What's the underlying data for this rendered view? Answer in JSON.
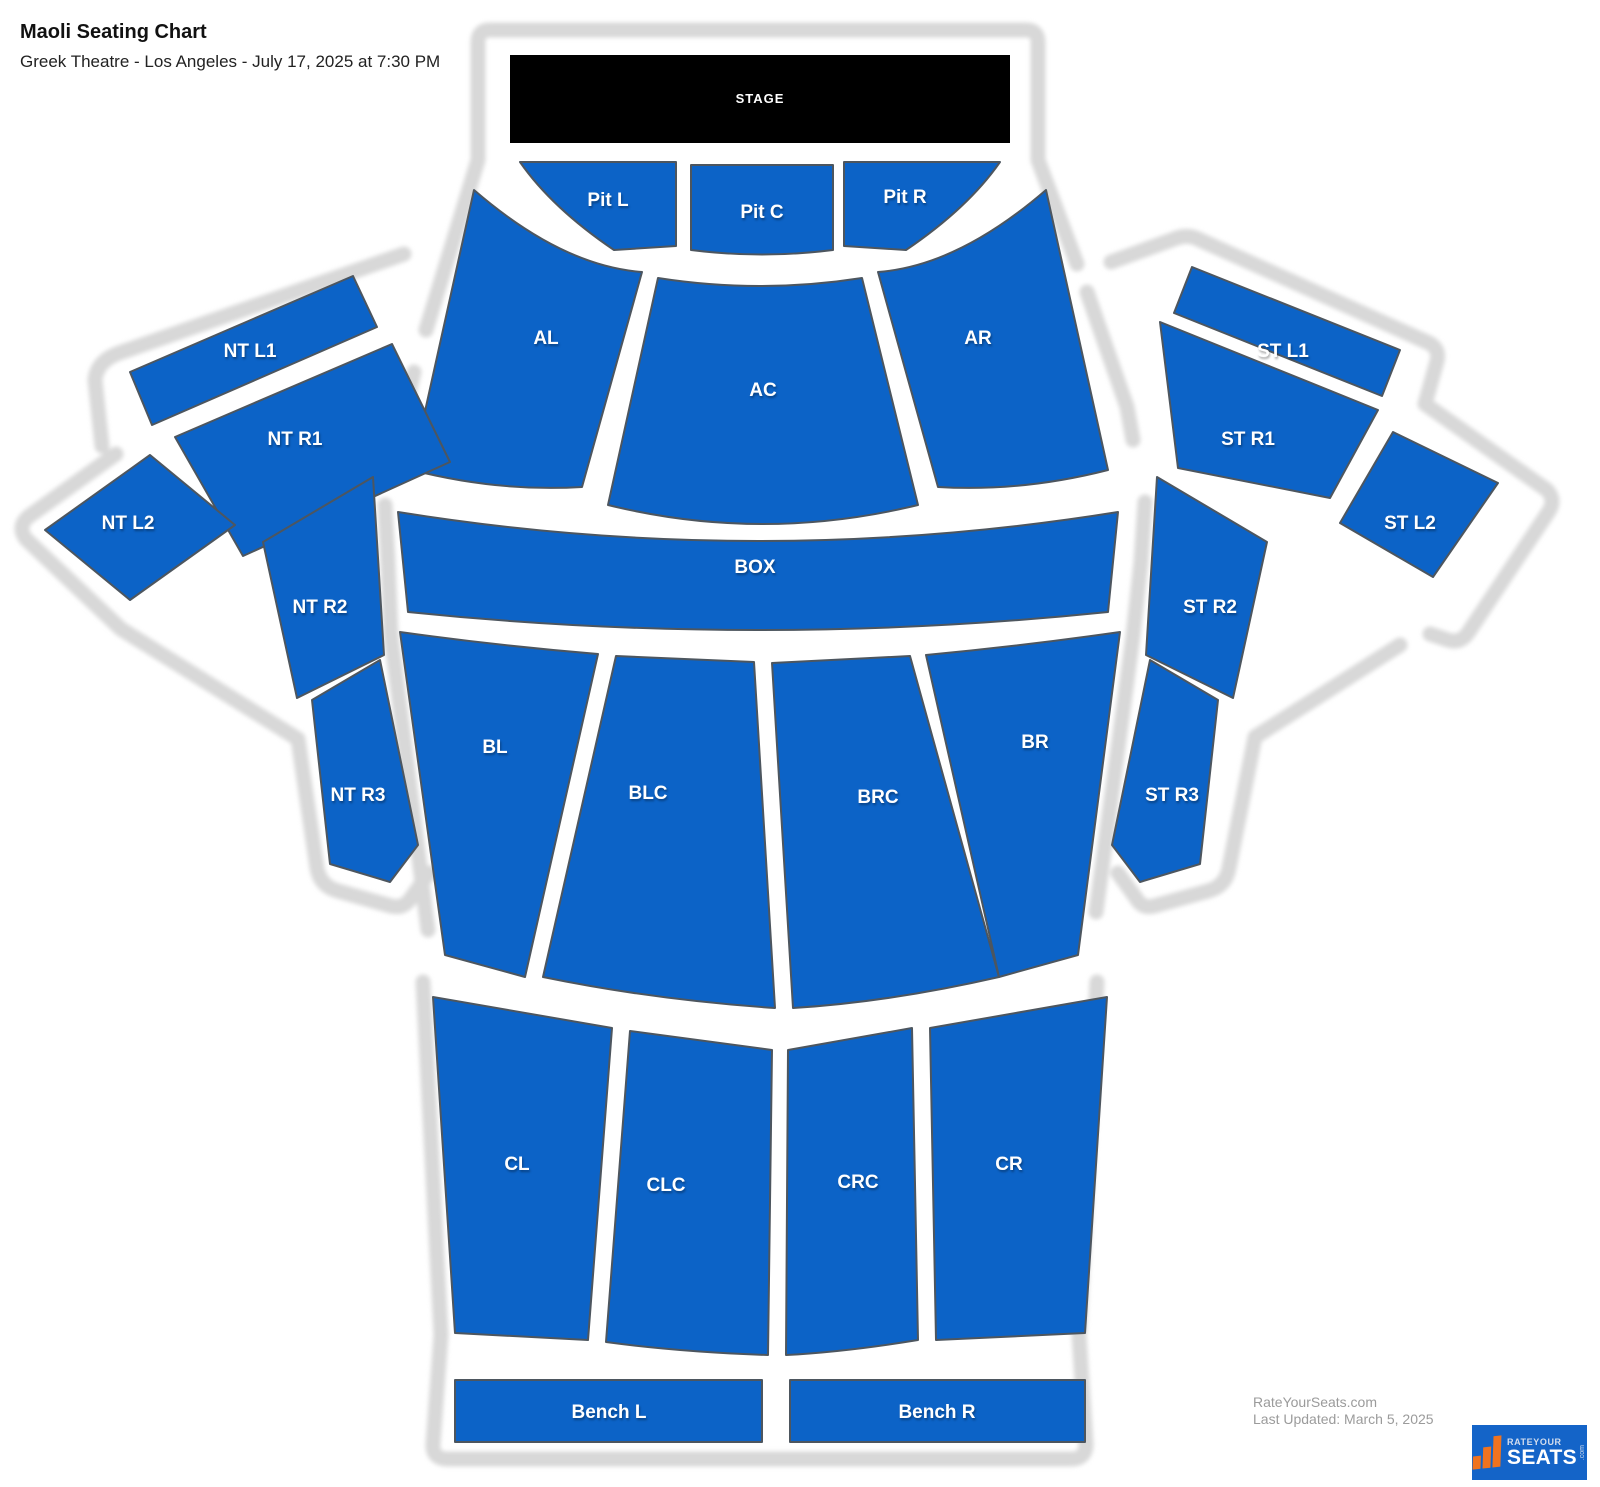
{
  "header": {
    "title": "Maoli Seating Chart",
    "subtitle": "Greek Theatre - Los Angeles - July 17, 2025 at 7:30 PM"
  },
  "stage": {
    "label": "STAGE"
  },
  "sections": {
    "pit_l": {
      "label": "Pit L"
    },
    "pit_c": {
      "label": "Pit C"
    },
    "pit_r": {
      "label": "Pit R"
    },
    "al": {
      "label": "AL"
    },
    "ac": {
      "label": "AC"
    },
    "ar": {
      "label": "AR"
    },
    "box": {
      "label": "BOX"
    },
    "nt_l1": {
      "label": "NT L1"
    },
    "nt_r1": {
      "label": "NT R1"
    },
    "nt_l2": {
      "label": "NT L2"
    },
    "nt_r2": {
      "label": "NT R2"
    },
    "nt_r3": {
      "label": "NT R3"
    },
    "st_l1": {
      "label": "ST L1"
    },
    "st_r1": {
      "label": "ST R1"
    },
    "st_l2": {
      "label": "ST L2"
    },
    "st_r2": {
      "label": "ST R2"
    },
    "st_r3": {
      "label": "ST R3"
    },
    "bl": {
      "label": "BL"
    },
    "blc": {
      "label": "BLC"
    },
    "brc": {
      "label": "BRC"
    },
    "br": {
      "label": "BR"
    },
    "cl": {
      "label": "CL"
    },
    "clc": {
      "label": "CLC"
    },
    "crc": {
      "label": "CRC"
    },
    "cr": {
      "label": "CR"
    },
    "bench_l": {
      "label": "Bench L"
    },
    "bench_r": {
      "label": "Bench R"
    }
  },
  "footer": {
    "site": "RateYourSeats.com",
    "updated": "Last Updated: March 5, 2025",
    "logo": {
      "line1": "RATEYOUR",
      "line2": "SEATS",
      "suffix": ".com"
    }
  },
  "colors": {
    "section_blue": "#0c63c7",
    "section_border": "#4d565f",
    "stage_black": "#000000",
    "outline_gray": "#d8d8d8",
    "logo_blue": "#1464c8",
    "logo_orange": "#f0731f"
  }
}
